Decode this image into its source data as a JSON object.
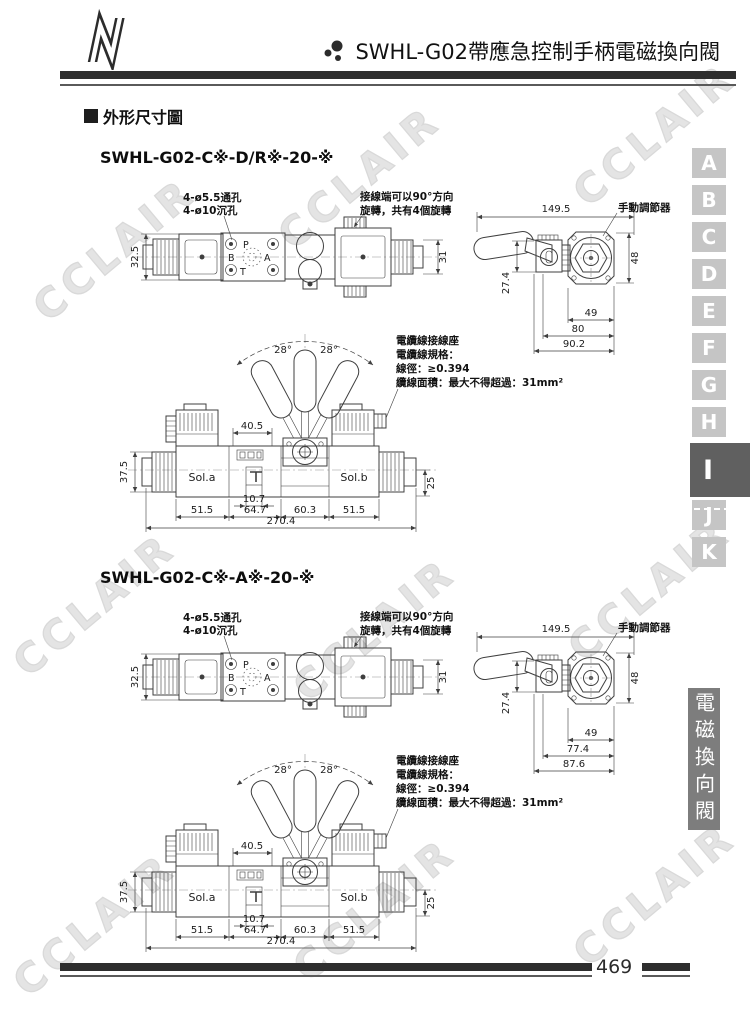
{
  "header": {
    "title": "SWHL-G02帶應急控制手柄電磁換向閥"
  },
  "heading": {
    "label": "外形尺寸圖"
  },
  "watermark": "CCLAIR",
  "side_tabs": {
    "letters": [
      "A",
      "B",
      "C",
      "D",
      "E",
      "F",
      "G",
      "H",
      "I",
      "J",
      "K"
    ],
    "active": "I"
  },
  "side_category": "電磁換向閥",
  "footer": {
    "page_number": "469"
  },
  "sections": [
    {
      "model": "SWHL-G02-C※-D/R※-20-※",
      "top_view": {
        "hole_note1": "4-ø5.5通孔",
        "hole_note2": "4-ø10沉孔",
        "rotate_note1": "接線端可以90°方向",
        "rotate_note2": "旋轉，共有4個旋轉",
        "dim_left": "32.5",
        "dim_right": "31",
        "port_p": "P",
        "port_a": "A",
        "port_b": "B",
        "port_t": "T"
      },
      "side_view": {
        "dim_top": "149.5",
        "adjuster": "手動調節器",
        "dim_right": "48",
        "dim_left": "27.4",
        "dim_b1": "49",
        "dim_b2": "80",
        "dim_b3": "90.2"
      },
      "front_view": {
        "angle_l": "28°",
        "angle_r": "28°",
        "dim_plate": "40.5",
        "dim_left": "37.5",
        "dim_right": "25",
        "sol_a": "Sol.a",
        "sol_b": "Sol.b",
        "dim_t": "10.7",
        "dim_r1": "51.5",
        "dim_r2": "64.7",
        "dim_r3": "60.3",
        "dim_r4": "51.5",
        "dim_total": "270.4",
        "cable_note1": "電纜線接線座",
        "cable_note2": "電纜線規格：",
        "cable_note3": "線徑：≥0.394",
        "cable_note4": "纜線面積：最大不得超過：31mm²"
      }
    },
    {
      "model": "SWHL-G02-C※-A※-20-※",
      "top_view": {
        "hole_note1": "4-ø5.5通孔",
        "hole_note2": "4-ø10沉孔",
        "rotate_note1": "接線端可以90°方向",
        "rotate_note2": "旋轉，共有4個旋轉",
        "dim_left": "32.5",
        "dim_right": "31",
        "port_p": "P",
        "port_a": "A",
        "port_b": "B",
        "port_t": "T"
      },
      "side_view": {
        "dim_top": "149.5",
        "adjuster": "手動調節器",
        "dim_right": "48",
        "dim_left": "27.4",
        "dim_b1": "49",
        "dim_b2": "77.4",
        "dim_b3": "87.6"
      },
      "front_view": {
        "angle_l": "28°",
        "angle_r": "28°",
        "dim_plate": "40.5",
        "dim_left": "37.5",
        "dim_right": "25",
        "sol_a": "Sol.a",
        "sol_b": "Sol.b",
        "dim_t": "10.7",
        "dim_r1": "51.5",
        "dim_r2": "64.7",
        "dim_r3": "60.3",
        "dim_r4": "51.5",
        "dim_total": "270.4",
        "cable_note1": "電纜線接線座",
        "cable_note2": "電纜線規格：",
        "cable_note3": "線徑：≥0.394",
        "cable_note4": "纜線面積：最大不得超過：31mm²"
      }
    }
  ]
}
